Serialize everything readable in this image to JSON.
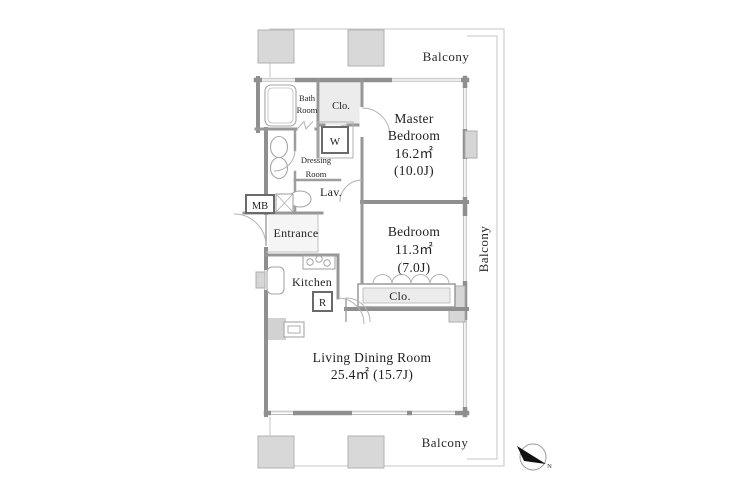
{
  "plan": {
    "colors": {
      "wall": "#8f8f8f",
      "boundary_line": "#c6c6c6",
      "pillar_fill": "#d8d8d8",
      "shaded_room": "#ececec",
      "block_fill": "#d6d6d6",
      "text": "#1f1f1f",
      "compass_fill": "#111111"
    },
    "labels": {
      "balcony_top": "Balcony",
      "balcony_right": "Balcony",
      "balcony_bottom": "Balcony",
      "bath_1": "Bath",
      "bath_2": "Room",
      "closet_top": "Clo.",
      "washer": "W",
      "dressing_1": "Dressing",
      "dressing_2": "Room",
      "lavatory": "Lav.",
      "meter_box": "MB",
      "entrance": "Entrance",
      "master_1": "Master",
      "master_2": "Bedroom",
      "master_area": "16.2㎡",
      "master_tatami": "(10.0J)",
      "bedroom_1": "Bedroom",
      "bedroom_area": "11.3㎡",
      "bedroom_tatami": "(7.0J)",
      "kitchen": "Kitchen",
      "refrigerator": "R",
      "closet_bedroom": "Clo.",
      "living_1": "Living Dining Room",
      "living_2": "25.4㎡ (15.7J)",
      "north": "N"
    }
  }
}
